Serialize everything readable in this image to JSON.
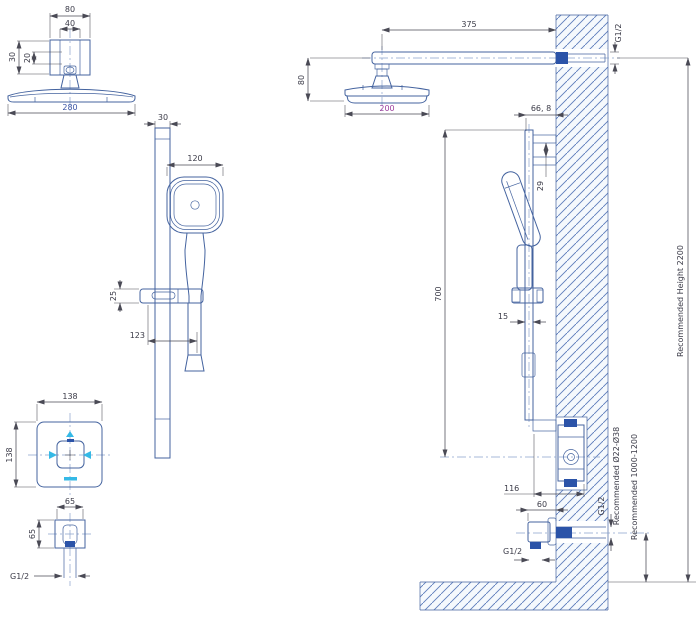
{
  "drawing": {
    "kind": "technical installation drawing",
    "subject": "shower column with overhead shower, hand shower slide bar and concealed mixer"
  },
  "colors": {
    "line_blue": "#44639f",
    "solid_blue": "#2b53a8",
    "fill_light": "#e9f3fb",
    "dim_gray": "#4a4a55",
    "magenta": "#9c3f9c",
    "cyan": "#35b9e6"
  },
  "views": {
    "overhead": {
      "width_outer": "80",
      "width_inner": "40",
      "height_outer": "30",
      "height_inner": "20",
      "head_width": "280"
    },
    "handshower": {
      "bar_width": "30",
      "head_width": "120",
      "bracket_height": "25",
      "reach": "123"
    },
    "mixer": {
      "plate_width": "138",
      "plate_height": "138"
    },
    "valve": {
      "width": "65",
      "height": "65",
      "thread": "G1/2"
    },
    "elevation": {
      "arm_length": "375",
      "arm_thread": "G1/2",
      "head_drop": "80",
      "head_width": "200",
      "bar_offset": "66, 8",
      "bracket_gap": "29",
      "bar_length": "700",
      "bar_depth": "15",
      "mixer_width": "116",
      "outlet_width": "60",
      "outlet_thread": "G1/2",
      "outlet_thread_bottom": "G1/2"
    },
    "notes": {
      "clamp_range": "Recommended Ø22-Ø38",
      "outlet_height": "Recommended 1000-1200",
      "overall_height": "Recommended Height 2200"
    }
  }
}
